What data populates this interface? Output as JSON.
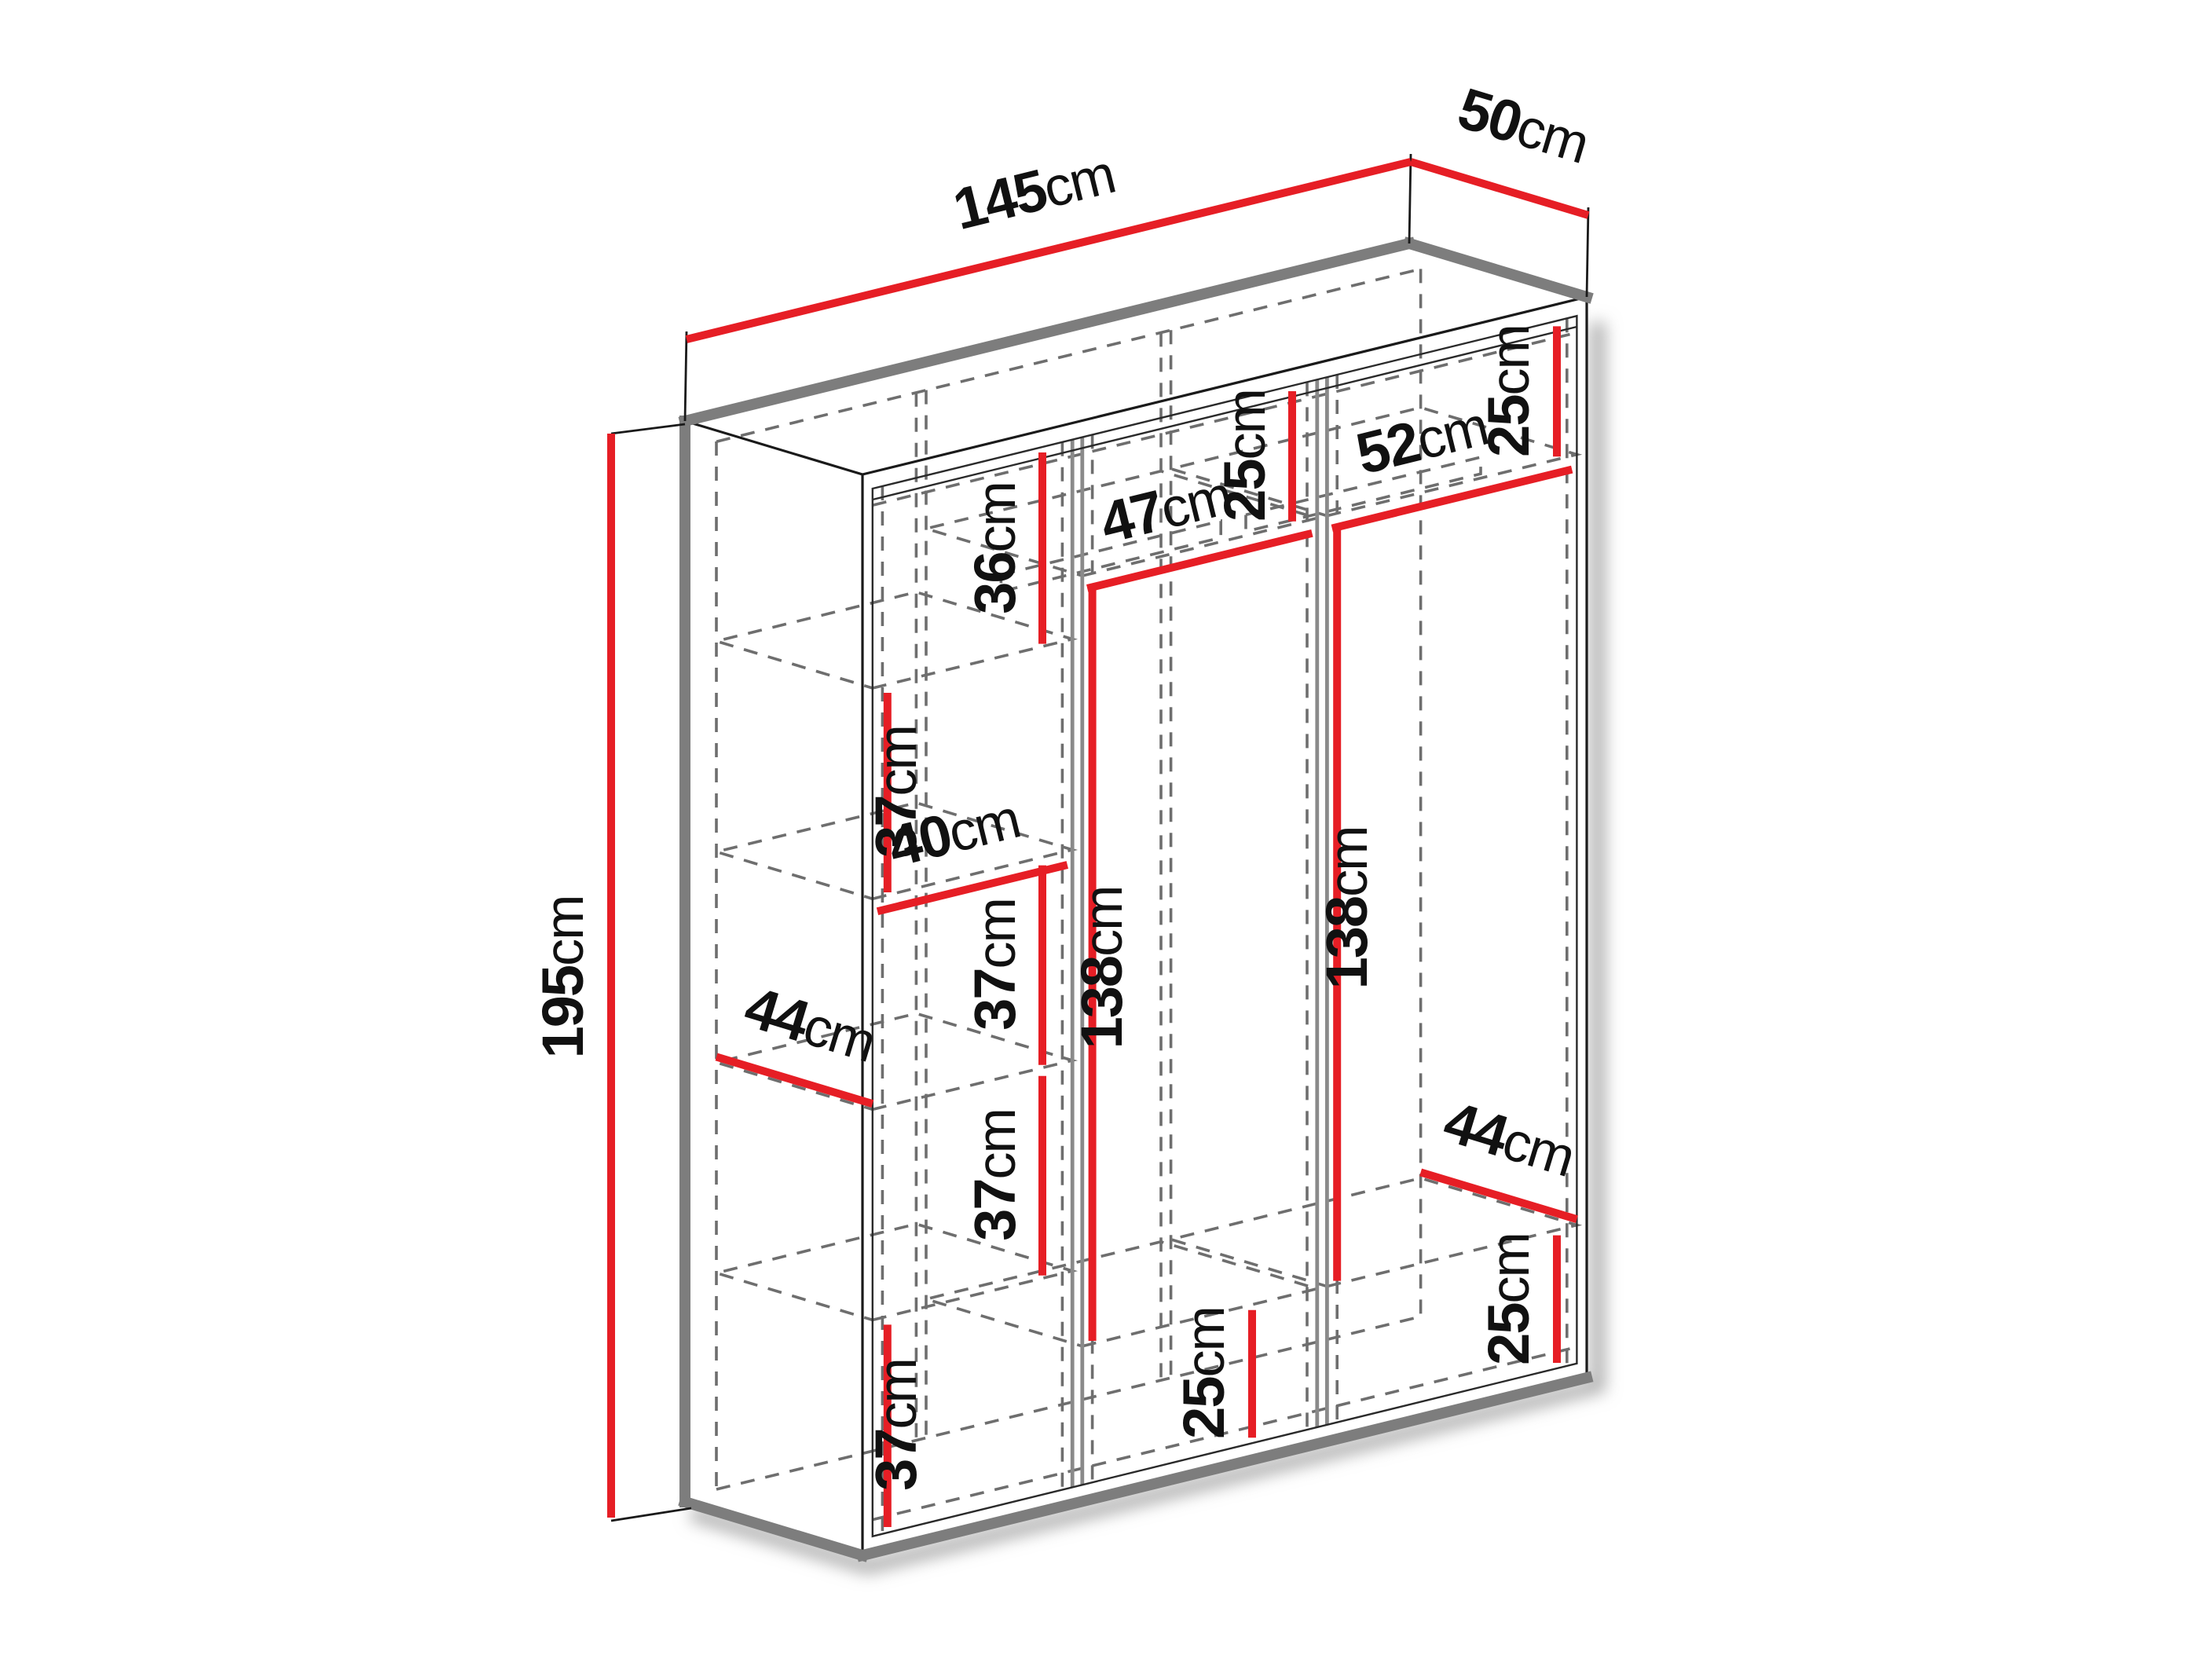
{
  "diagram": {
    "type": "furniture-dimension-diagram",
    "subject": "three-section wardrobe interior dimensions",
    "unit": "cm",
    "accent_color": "#e61e25",
    "outline_color": "#7d7d7d",
    "text_color": "#111111",
    "overall": {
      "width": {
        "num": "145",
        "unit": "cm"
      },
      "depth": {
        "num": "50",
        "unit": "cm"
      },
      "height": {
        "num": "195",
        "unit": "cm"
      }
    },
    "left_column": {
      "section1_height": {
        "num": "36",
        "unit": "cm"
      },
      "section2_height": {
        "num": "37",
        "unit": "cm"
      },
      "inner_width": {
        "num": "40",
        "unit": "cm"
      },
      "shelf_depth": {
        "num": "44",
        "unit": "cm"
      },
      "section3_height": {
        "num": "37",
        "unit": "cm"
      },
      "section4_height": {
        "num": "37",
        "unit": "cm"
      },
      "section5_height": {
        "num": "37",
        "unit": "cm"
      }
    },
    "middle_column": {
      "top_section_height": {
        "num": "25",
        "unit": "cm"
      },
      "inner_width": {
        "num": "47",
        "unit": "cm"
      },
      "hanging_height": {
        "num": "138",
        "unit": "cm"
      },
      "bottom_section_height": {
        "num": "25",
        "unit": "cm"
      }
    },
    "right_column": {
      "top_section_height": {
        "num": "25",
        "unit": "cm"
      },
      "inner_width": {
        "num": "52",
        "unit": "cm"
      },
      "hanging_height": {
        "num": "138",
        "unit": "cm"
      },
      "shelf_depth": {
        "num": "44",
        "unit": "cm"
      },
      "bottom_section_height": {
        "num": "25",
        "unit": "cm"
      }
    }
  }
}
